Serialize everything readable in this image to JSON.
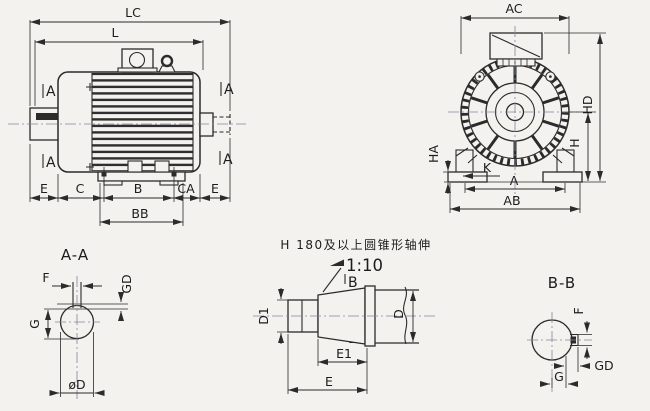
{
  "colors": {
    "line": "#2b2b2b",
    "paper": "#f4f2ef",
    "centerline": "#7e889a"
  },
  "side_view": {
    "section_marker": "A",
    "dim_lc": "LC",
    "dim_l": "L",
    "dim_e_left": "E",
    "dim_c": "C",
    "dim_b": "B",
    "dim_ca": "CA",
    "dim_e_right": "E",
    "dim_bb": "BB"
  },
  "front_view": {
    "dim_ac": "AC",
    "dim_hd": "HD",
    "dim_h": "H",
    "dim_ha": "HA",
    "dim_k": "K",
    "dim_a": "A",
    "dim_ab": "AB"
  },
  "section_aa": {
    "title": "A-A",
    "dim_f": "F",
    "dim_gd": "GD",
    "dim_g": "G",
    "dim_od": "øD"
  },
  "taper_note": {
    "text": "H 180及以上圆锥形轴伸",
    "ratio": "1:10",
    "section_marker": "B",
    "dim_d1": "D1",
    "dim_d": "D",
    "dim_e1": "E1",
    "dim_e": "E"
  },
  "section_bb": {
    "title": "B-B",
    "dim_f": "F",
    "dim_gd": "GD",
    "dim_g": "G"
  }
}
